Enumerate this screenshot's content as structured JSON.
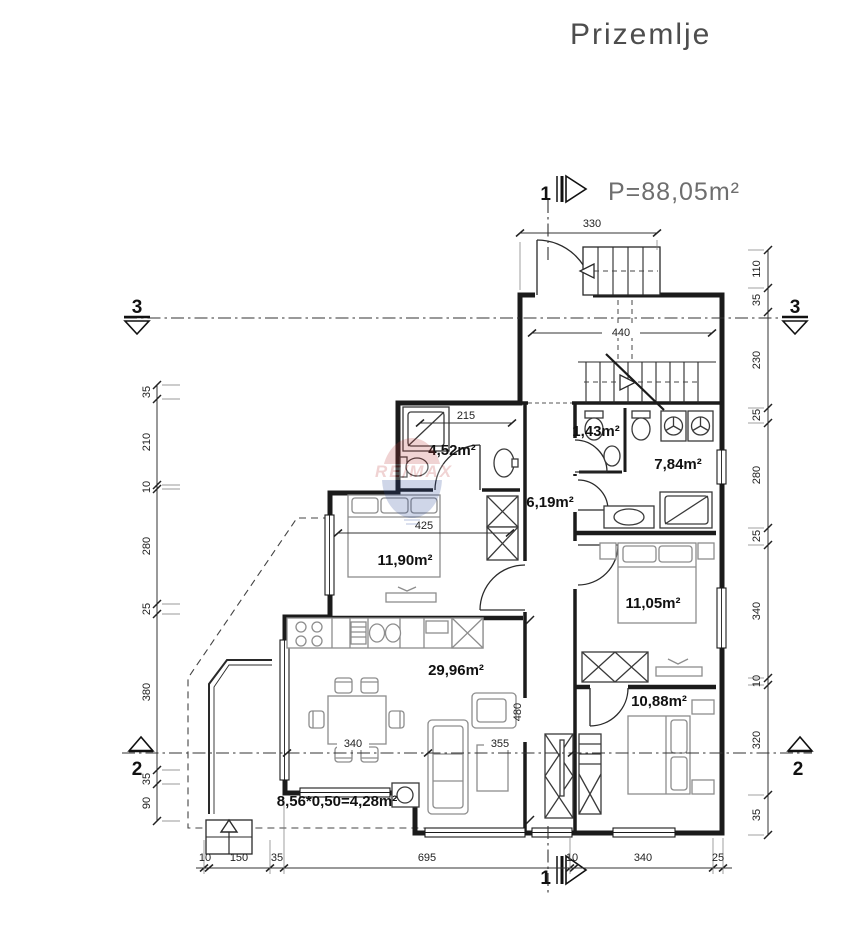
{
  "drawing": {
    "title": "Prizemlje",
    "total_area": "P=88,05m²",
    "watermark": "RE/MAX"
  },
  "rooms": {
    "bathroom": "4,52m²",
    "wc": "1,43m²",
    "bathroom2": "7,84m²",
    "hallway": "6,19m²",
    "bedroom1": "11,90m²",
    "bedroom2": "11,05m²",
    "living": "29,96m²",
    "bedroom3": "10,88m²",
    "terrace": "8,56*0,50=4,28m²"
  },
  "dims": {
    "top": "330",
    "stairwell": "440",
    "bathroom": "215",
    "bedroom1": "425",
    "living_a": "340",
    "living_b": "355",
    "hall_h": "480",
    "left": [
      "35",
      "210",
      "10",
      "280",
      "25",
      "380",
      "35",
      "90"
    ],
    "right": [
      "110",
      "35",
      "230",
      "25",
      "280",
      "25",
      "340",
      "10",
      "320",
      "35"
    ],
    "bottom": [
      "10",
      "150",
      "35",
      "695",
      "10",
      "340",
      "25"
    ]
  },
  "sections": {
    "one": "1",
    "two": "2",
    "three": "3"
  }
}
